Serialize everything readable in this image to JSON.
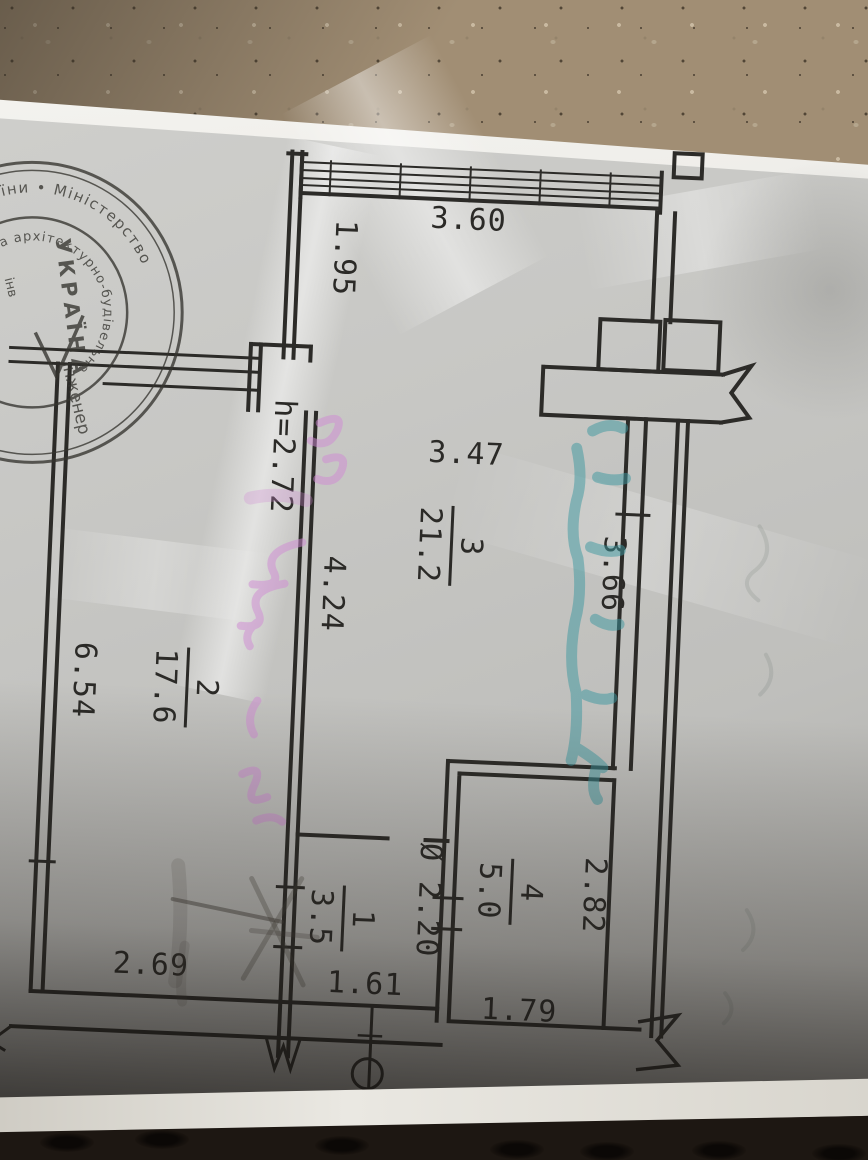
{
  "plan": {
    "dims": {
      "top_window_width": "3.60",
      "upper_left_height": "1.95",
      "room3_width": "3.47",
      "room3_height_right": "3.66",
      "room3_height_left": "4.24",
      "ceiling_height": "h=2.72",
      "room2_height": "6.54",
      "room2_width": "2.69",
      "room1_width": "1.61",
      "room1_height": "Ø 2.20",
      "room4_height": "2.82",
      "room4_width": "1.79"
    },
    "rooms": [
      {
        "number": "3",
        "area": "21.2"
      },
      {
        "number": "2",
        "area": "17.6"
      },
      {
        "number": "4",
        "area": "5.0"
      },
      {
        "number": "1",
        "area": "3.5"
      }
    ]
  },
  "stamp": {
    "outer_arc": "господарства україни • Міністерство",
    "inner_arc": "інвестиційна архітектурно-будівельна",
    "center_word": "УКРАЇНА",
    "center_title": "Інженер",
    "fragment": "інв"
  },
  "colors": {
    "ink": "#2b2a27",
    "teal_marker": "#3d98a0",
    "pink_marker": "#d08ad4",
    "paper": "#c7c7c4",
    "concrete": "#a18e74"
  }
}
